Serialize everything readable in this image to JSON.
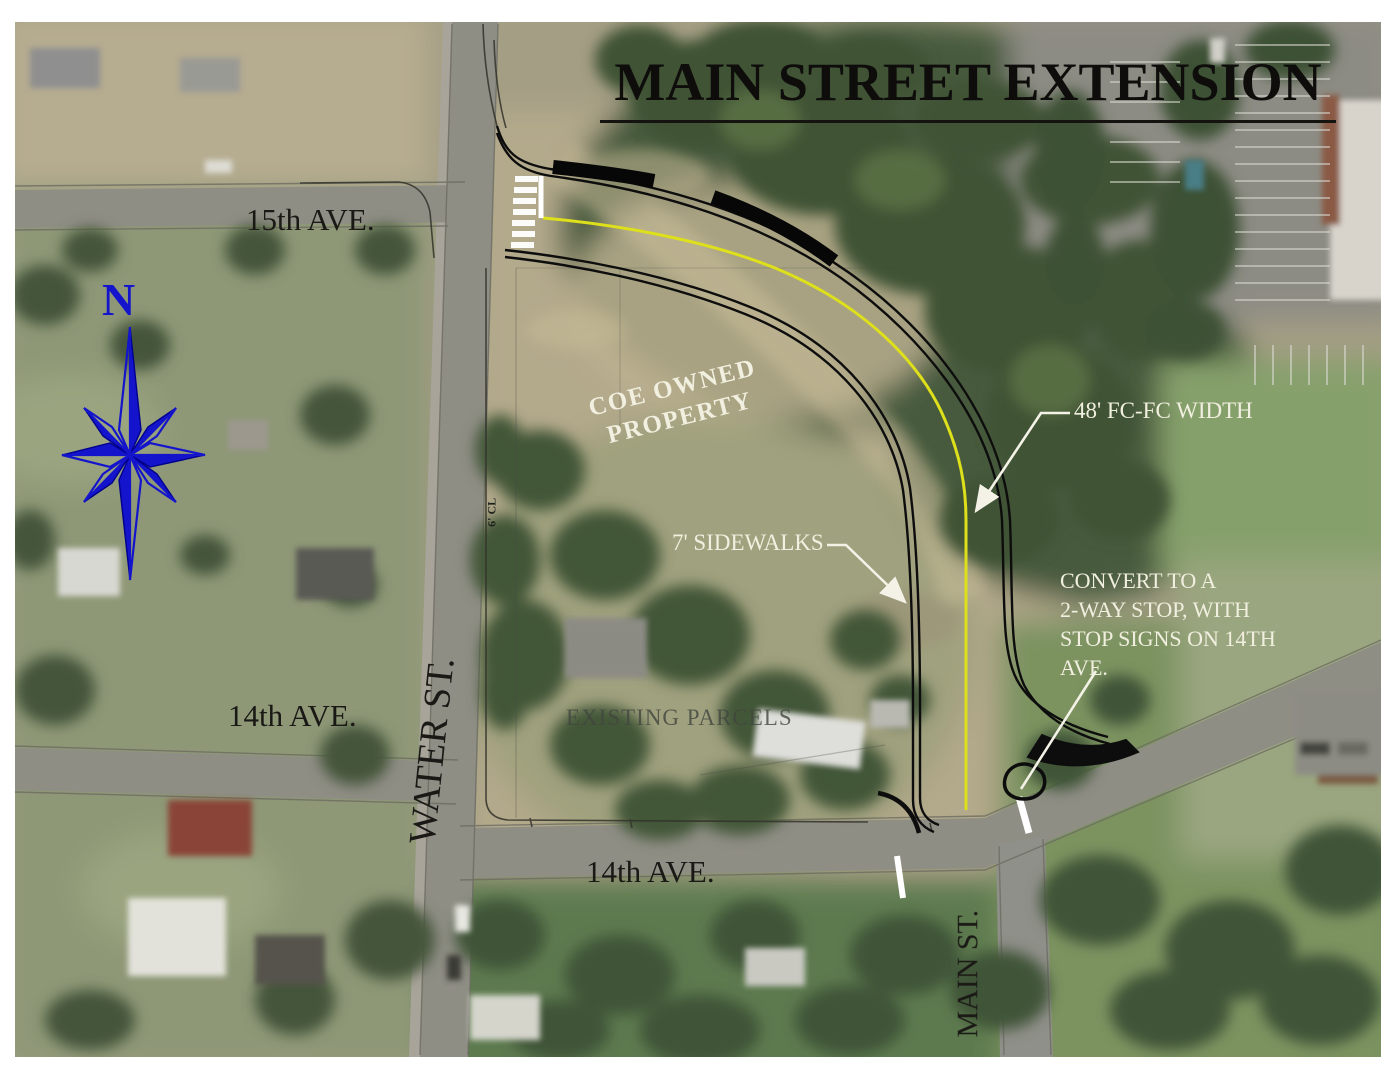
{
  "title": {
    "text": "MAIN STREET EXTENSION"
  },
  "compass": {
    "label": "N"
  },
  "street_labels": {
    "fifteenth_ave": "15th AVE.",
    "water_st": "WATER ST.",
    "fourteenth_ave_west": "14th AVE.",
    "fourteenth_ave_center": "14th AVE.",
    "main_st": "MAIN ST."
  },
  "annotations": {
    "coe_property_line1": "COE OWNED",
    "coe_property_line2": "PROPERTY",
    "existing_parcels": "EXISTING PARCELS",
    "fc_width": "48' FC-FC WIDTH",
    "sidewalks": "7' SIDEWALKS",
    "convert_line1": "CONVERT TO A",
    "convert_line2": "2-WAY STOP, WITH",
    "convert_line3": "STOP SIGNS ON 14TH",
    "convert_line4": "AVE.",
    "cl_offset": "6' CL"
  },
  "colors": {
    "annotation_white": "#f1efdf",
    "centerline_yellow": "#dde01a",
    "linework_black": "#0d0d0d",
    "compass_blue": "#1414cc",
    "label_black": "#1a1915"
  }
}
